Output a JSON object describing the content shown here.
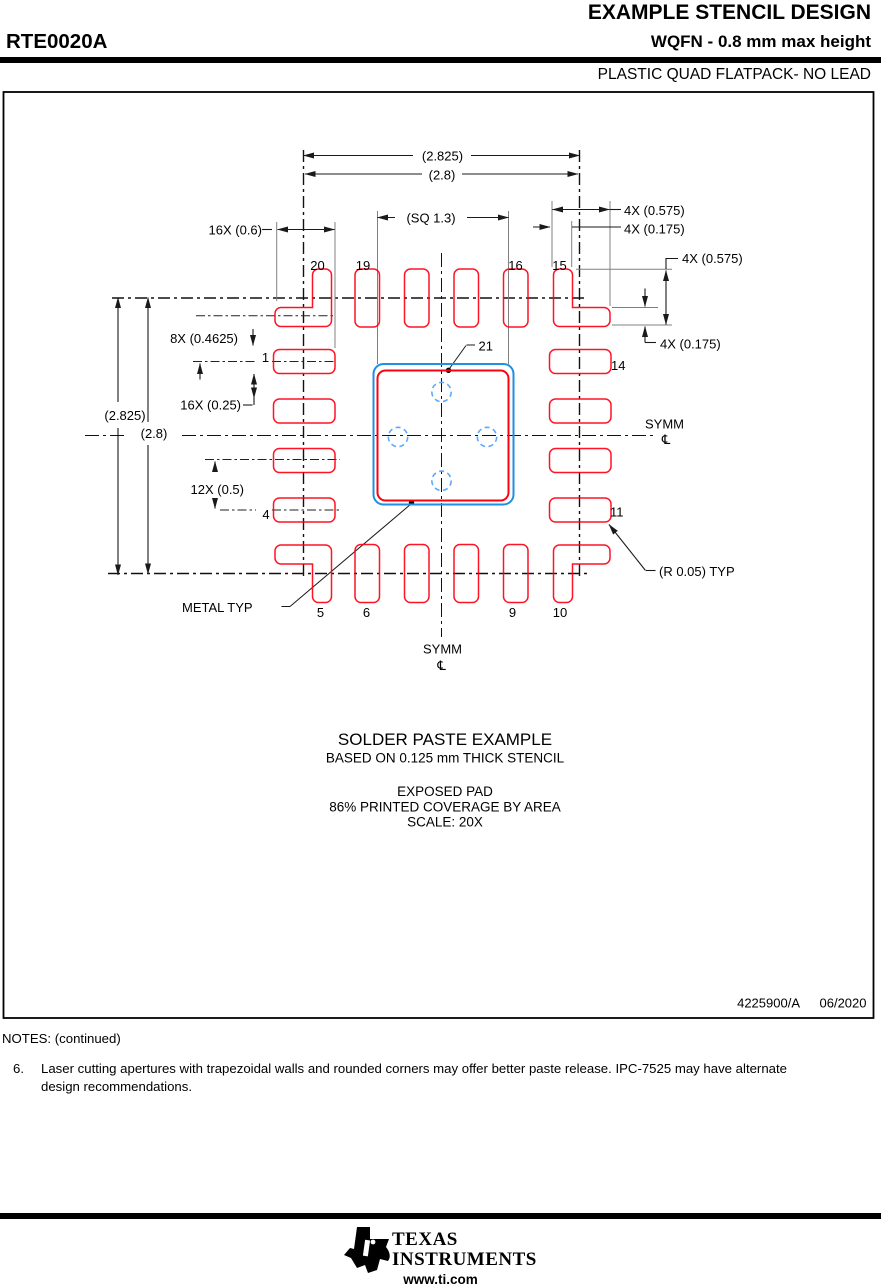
{
  "header": {
    "doc_title": "EXAMPLE STENCIL DESIGN",
    "part_number": "RTE0020A",
    "package_spec": "WQFN - 0.8 mm max height",
    "package_family": "PLASTIC QUAD FLATPACK- NO LEAD"
  },
  "drawing": {
    "dims": {
      "width_outer": "(2.825)",
      "width_inner": "(2.8)",
      "height_outer": "(2.825)",
      "height_inner": "(2.8)",
      "center_pad": "(SQ 1.3)",
      "pad_length": "16X (0.6)",
      "row_offset": "8X (0.4625)",
      "pad_width": "16X (0.25)",
      "pad_pitch": "12X (0.5)",
      "corner_len_top": "4X (0.575)",
      "corner_wid_top": "4X (0.175)",
      "corner_len_right": "4X (0.575)",
      "corner_wid_right": "4X (0.175)"
    },
    "labels": {
      "metal": "METAL TYP",
      "radius": "(R 0.05) TYP",
      "symm": "SYMM",
      "centerline": "℄"
    },
    "pins": {
      "p1": "1",
      "p4": "4",
      "p5": "5",
      "p6": "6",
      "p9": "9",
      "p10": "10",
      "p11": "11",
      "p14": "14",
      "p15": "15",
      "p16": "16",
      "p19": "19",
      "p20": "20",
      "p21": "21"
    }
  },
  "caption": {
    "title": "SOLDER PASTE EXAMPLE",
    "subtitle": "BASED ON 0.125 mm THICK STENCIL",
    "line3": "EXPOSED PAD",
    "line4": "86% PRINTED COVERAGE BY AREA",
    "line5": "SCALE: 20X"
  },
  "title_block": {
    "doc_number": "4225900/A",
    "date": "06/2020"
  },
  "notes": {
    "heading": "NOTES: (continued)",
    "item_number": "6.",
    "line1": "Laser cutting apertures with trapezoidal walls and rounded corners may offer better paste release. IPC-7525 may have alternate",
    "line2": "design recommendations."
  },
  "footer": {
    "brand_top": "TEXAS",
    "brand_bottom": "INSTRUMENTS",
    "website": "www.ti.com"
  },
  "colors": {
    "pad_red": "#ff0012",
    "center_blue": "#1f8fe0",
    "via_blue": "#5aa9ff",
    "ink": "#1a1a1a",
    "gray": "#808080"
  }
}
